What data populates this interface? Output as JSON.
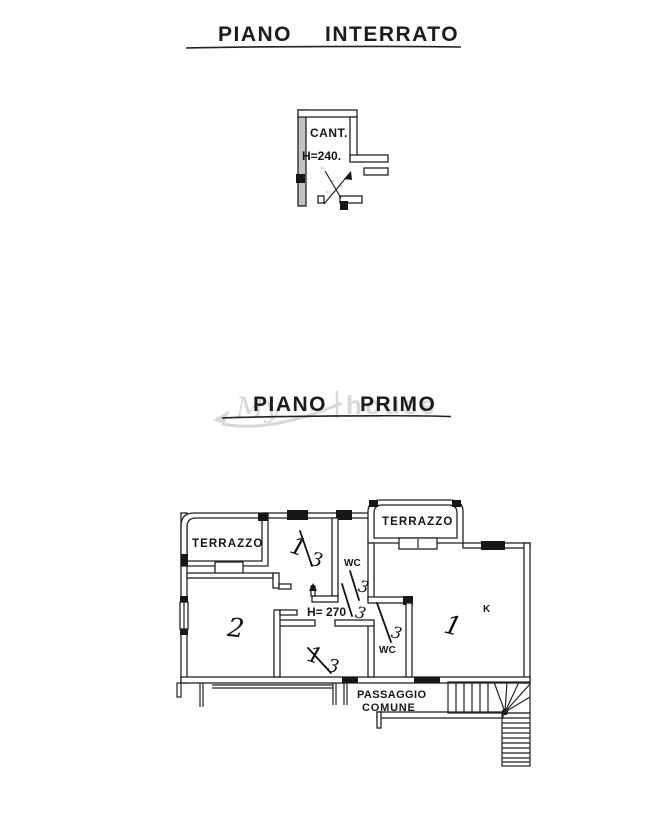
{
  "colors": {
    "ink": "#1f1f1f",
    "paper": "#ffffff",
    "watermark": "#9b9b9b",
    "wall_shade": "#c2c2c2"
  },
  "basement": {
    "title": {
      "word1": "PIANO",
      "word2": "INTERRATO"
    },
    "room_label": "CANT.",
    "height_label": "H=240."
  },
  "first_floor": {
    "title": {
      "word1": "PIANO",
      "word2": "PRIMO"
    },
    "watermark": {
      "part1": "My",
      "part2": "house"
    },
    "labels": {
      "terrace_left": "TERRAZZO",
      "terrace_right": "TERRAZZO",
      "wc_upper": "WC",
      "wc_lower": "WC",
      "ceiling_height": "H= 270",
      "kitchen": "K",
      "passage_line1": "PASSAGGIO",
      "passage_line2": "COMUNE"
    },
    "handwritten": {
      "room1": "1",
      "room2": "2",
      "fraction_top_num": "1",
      "fraction_top_den": "3",
      "fraction_mid_a_den": "3",
      "fraction_mid_b_den": "3",
      "fraction_lower_den": "3",
      "fraction_bottom_num": "1",
      "fraction_bottom_den": "3"
    }
  }
}
